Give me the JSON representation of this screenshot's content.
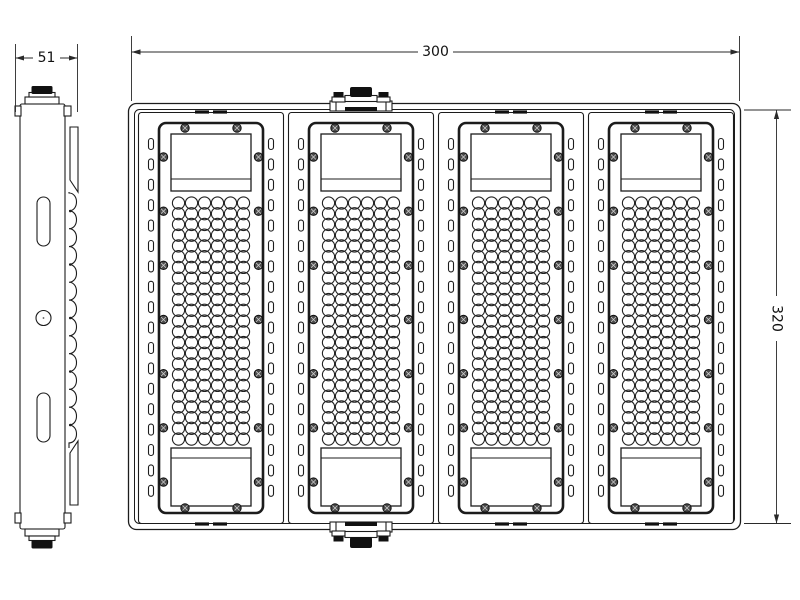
{
  "dimensions": {
    "width": "300",
    "height": "320",
    "depth": "51"
  },
  "front_view": {
    "modules_count": 4,
    "module": {
      "vent_slots_per_side": 18,
      "side_screws_per_side": 7,
      "top_screws": 2,
      "bottom_screws": 2,
      "hole_cols": 6,
      "hole_rows": 23
    },
    "cable_glands": 2
  },
  "side_view": {
    "mounting_slots": 2,
    "mounting_holes": 1,
    "fin_bumps": 14,
    "fin_dots": 5
  },
  "colors": {
    "line": "#1c1c1c",
    "dark_fill": "#111111",
    "screw_fill": "#4a4a4a",
    "screw_cross": "#c9c9c9",
    "background": "#ffffff"
  }
}
